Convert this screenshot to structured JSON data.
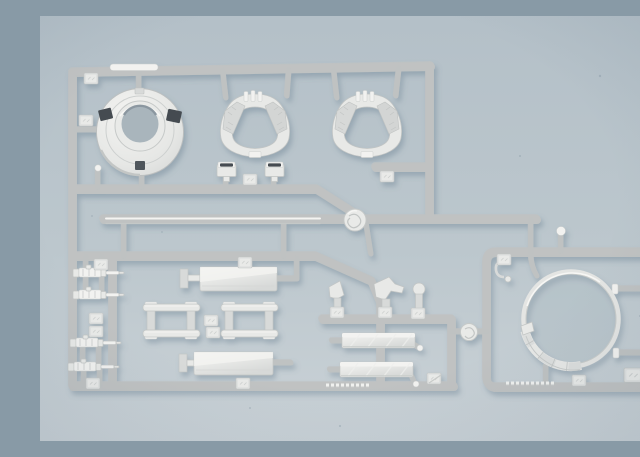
{
  "scene": {
    "description": "Close-up photograph of a light grey injection-moulded model-kit sprue (parts tree) with armoured-vehicle detail parts, lying on a pale blue-grey mat",
    "plastic": "light grey styrene with glossy highlights",
    "surface": "pale blue-grey photographic background, lighter toward the bottom",
    "legible_text": "none — embossed part-number tags and runner lettering are present but too small and low-contrast to read"
  },
  "colors": {
    "bg_top": "#b4c0c8",
    "bg_bottom": "#cad2d7",
    "plastic_light": "#f2f2f0",
    "plastic_mid": "#e8e9e7",
    "plastic_dark": "#bfc2c2",
    "plastic_highlight": "#f8f8f6",
    "slot_dark": "#454c51",
    "hole_shadow": "#a9b5bc",
    "cast_shadow": "#5c7386"
  },
  "parts": [
    {
      "label": "moulding runner frame"
    },
    {
      "label": "commander cupola ring with dark vision slots"
    },
    {
      "label": "curved saddle ring part (left)"
    },
    {
      "label": "curved saddle ring part (right)"
    },
    {
      "label": "periscope block with dark slot (left)"
    },
    {
      "label": "periscope block with dark slot (right)"
    },
    {
      "label": "long barrel rod moulded along centre runner"
    },
    {
      "label": "four small machine-gun parts on left rail"
    },
    {
      "label": "upper rectangular hatch panel"
    },
    {
      "label": "lower rectangular hatch panel"
    },
    {
      "label": "ladder-style bracket frame (left)"
    },
    {
      "label": "ladder-style bracket frame (right)"
    },
    {
      "label": "three small lever and knob parts"
    },
    {
      "label": "two louvred slat panels"
    },
    {
      "label": "large turret-ring band inside right frame"
    },
    {
      "label": "embossed part-number tags (illegible)"
    },
    {
      "label": "injection-gate swirl marks"
    },
    {
      "label": "small hook part inside right frame"
    }
  ]
}
